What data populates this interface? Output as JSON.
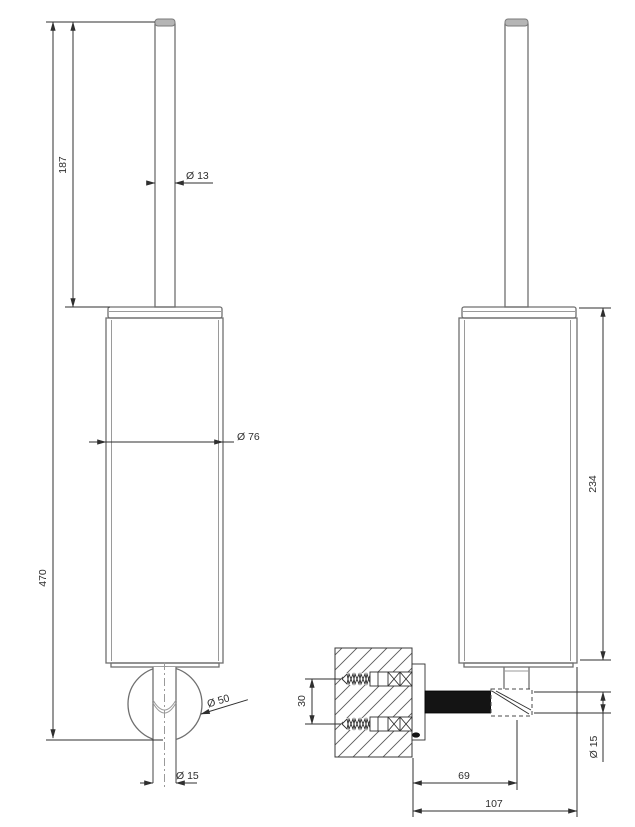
{
  "drawing": {
    "type": "technical-dimension-drawing",
    "subject": "wall-mounted toilet brush holder, front and side views",
    "colors": {
      "background": "#ffffff",
      "dimension_line": "#2f2f2f",
      "object_line": "#6f6f6f",
      "cap_fill": "#b5b5b5",
      "arm_fill": "#141414"
    },
    "front_view": {
      "name": "front view",
      "dimensions": {
        "total_height": "470",
        "handle_length": "187",
        "handle_diameter": "Ø 13",
        "body_diameter": "Ø 76",
        "wall_flange_diameter": "Ø 50",
        "bottom_rod_diameter": "Ø 15"
      }
    },
    "side_view": {
      "name": "side view",
      "dimensions": {
        "holder_height": "234",
        "screw_spacing": "30",
        "arm_diameter": "Ø 15",
        "wall_to_rod_axis": "69",
        "wall_to_front_edge": "107"
      }
    }
  }
}
